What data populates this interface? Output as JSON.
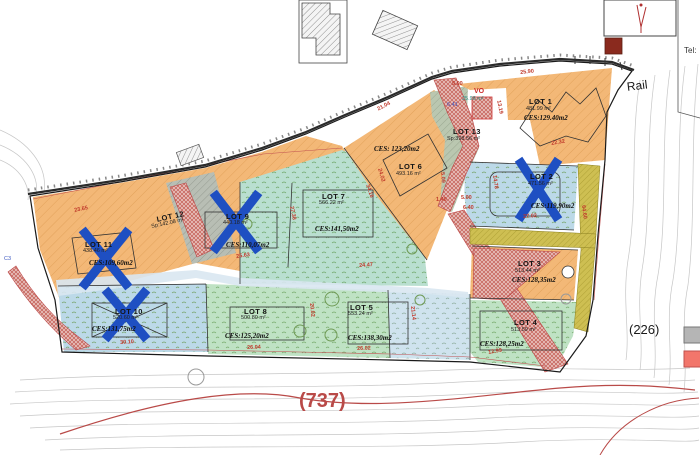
{
  "labels": {
    "rail": "Rail",
    "parcel_226": "(226)",
    "contour_737": "(737)",
    "tel": "Tel:"
  },
  "colors": {
    "x_mark": "#1e4fc2",
    "legend_gray": "#b5b5b5",
    "legend_red": "#f2766b",
    "contour_line_red": "#b94a48"
  },
  "lots": [
    {
      "name": "LOT 1",
      "area": "481.99 m²",
      "ces": "CES:129.40m2",
      "npos": [
        529,
        98
      ],
      "apos": [
        526,
        107
      ],
      "cpos": [
        524,
        115
      ]
    },
    {
      "name": "LOT 2",
      "area": "471.56 m²",
      "ces": "CES:119,90m2",
      "npos": [
        530,
        173
      ],
      "apos": [
        528,
        182
      ],
      "cpos": [
        531,
        203
      ]
    },
    {
      "name": "LOT 3",
      "area": "513.44 m²",
      "ces": "CES:128,35m2",
      "npos": [
        518,
        260
      ],
      "apos": [
        515,
        269
      ],
      "cpos": [
        512,
        277
      ]
    },
    {
      "name": "LOT 4",
      "area": "513.59 m²",
      "ces": "CES:128,25m2",
      "npos": [
        514,
        319
      ],
      "apos": [
        511,
        328
      ],
      "cpos": [
        480,
        341
      ]
    },
    {
      "name": "LOT 5",
      "area": "553.24 m²",
      "ces": "CES:138,30m2",
      "npos": [
        350,
        304
      ],
      "apos": [
        348,
        312
      ],
      "cpos": [
        348,
        335
      ]
    },
    {
      "name": "LOT 6",
      "area": "493.16 m²",
      "ces": "CES: 123,20m2",
      "npos": [
        399,
        163
      ],
      "apos": [
        396,
        172
      ],
      "cpos": [
        374,
        146
      ]
    },
    {
      "name": "LOT 7",
      "area": "566.22 m²",
      "ces": "CES:141,50m2",
      "npos": [
        322,
        193
      ],
      "apos": [
        319,
        201
      ],
      "cpos": [
        315,
        226
      ]
    },
    {
      "name": "LOT 8",
      "area": "500.80 m²",
      "ces": "CES:125,20m2",
      "npos": [
        244,
        308
      ],
      "apos": [
        241,
        316
      ],
      "cpos": [
        225,
        333
      ]
    },
    {
      "name": "LOT 9",
      "area": "440.18 m²",
      "ces": "CES:110,07m2",
      "npos": [
        226,
        213
      ],
      "apos": [
        223,
        221
      ],
      "cpos": [
        226,
        242
      ]
    },
    {
      "name": "LOT 10",
      "area": "520.60 m²",
      "ces": "CES:131,75m2",
      "npos": [
        115,
        308
      ],
      "apos": [
        113,
        316
      ],
      "cpos": [
        92,
        326
      ]
    },
    {
      "name": "LOT 11",
      "area": "438.46 m²",
      "ces": "CES:109,60m2",
      "npos": [
        85,
        241
      ],
      "apos": [
        83,
        249
      ],
      "cpos": [
        89,
        260
      ]
    },
    {
      "name": "LOT 12",
      "sp": "Sp:142.08 m²",
      "npos": [
        156,
        216
      ],
      "spos": [
        151,
        225
      ],
      "rot": -12
    },
    {
      "name": "LOT 13",
      "sp": "Sp:398.56 m²",
      "npos": [
        453,
        128
      ],
      "spos": [
        447,
        137
      ]
    }
  ],
  "dimensions": [
    {
      "t": "25.90",
      "x": 520,
      "y": 71,
      "r": -6
    },
    {
      "t": "22.32",
      "x": 551,
      "y": 142,
      "r": -10
    },
    {
      "t": "23.65",
      "x": 74,
      "y": 209,
      "r": -12
    },
    {
      "t": "25.63",
      "x": 236,
      "y": 255,
      "r": -8
    },
    {
      "t": "27.38",
      "x": 293,
      "y": 206,
      "r": 78
    },
    {
      "t": "34.16",
      "x": 369,
      "y": 184,
      "r": 72
    },
    {
      "t": "24.02",
      "x": 381,
      "y": 168,
      "r": 74
    },
    {
      "t": "21.04",
      "x": 377,
      "y": 108,
      "r": -28
    },
    {
      "t": "5.00",
      "x": 452,
      "y": 82,
      "r": 0
    },
    {
      "t": "13.19",
      "x": 500,
      "y": 100,
      "r": 78
    },
    {
      "t": "14.78",
      "x": 496,
      "y": 175,
      "r": 82
    },
    {
      "t": "5.09",
      "x": 444,
      "y": 172,
      "r": 85
    },
    {
      "t": "1.40",
      "x": 436,
      "y": 198,
      "r": 0
    },
    {
      "t": "5.00",
      "x": 461,
      "y": 196,
      "r": 0
    },
    {
      "t": "6.40",
      "x": 463,
      "y": 206,
      "r": 0
    },
    {
      "t": "27.02",
      "x": 523,
      "y": 215,
      "r": -4
    },
    {
      "t": "64.60",
      "x": 585,
      "y": 205,
      "r": 83
    },
    {
      "t": "30.10",
      "x": 120,
      "y": 341,
      "r": -4
    },
    {
      "t": "26.04",
      "x": 247,
      "y": 346,
      "r": -2
    },
    {
      "t": "20.02",
      "x": 313,
      "y": 303,
      "r": 84
    },
    {
      "t": "21.14",
      "x": 414,
      "y": 306,
      "r": 84
    },
    {
      "t": "26.02",
      "x": 357,
      "y": 347,
      "r": -2
    },
    {
      "t": "12.99",
      "x": 488,
      "y": 351,
      "r": -10
    },
    {
      "t": "24.47",
      "x": 359,
      "y": 264,
      "r": -4
    }
  ],
  "notes": [
    {
      "t": "VO",
      "cls": "vo",
      "name": "vo-area-label",
      "x": 474,
      "y": 88
    },
    {
      "t": "25.98 m²",
      "cls": "teal",
      "name": "vo-area-size-label",
      "x": 462,
      "y": 97
    },
    {
      "t": "6.41",
      "cls": "blue",
      "name": "measure-note-641",
      "x": 447,
      "y": 103
    },
    {
      "t": "C3",
      "cls": "blue",
      "name": "grid-ref-label",
      "x": 4,
      "y": 257
    }
  ]
}
